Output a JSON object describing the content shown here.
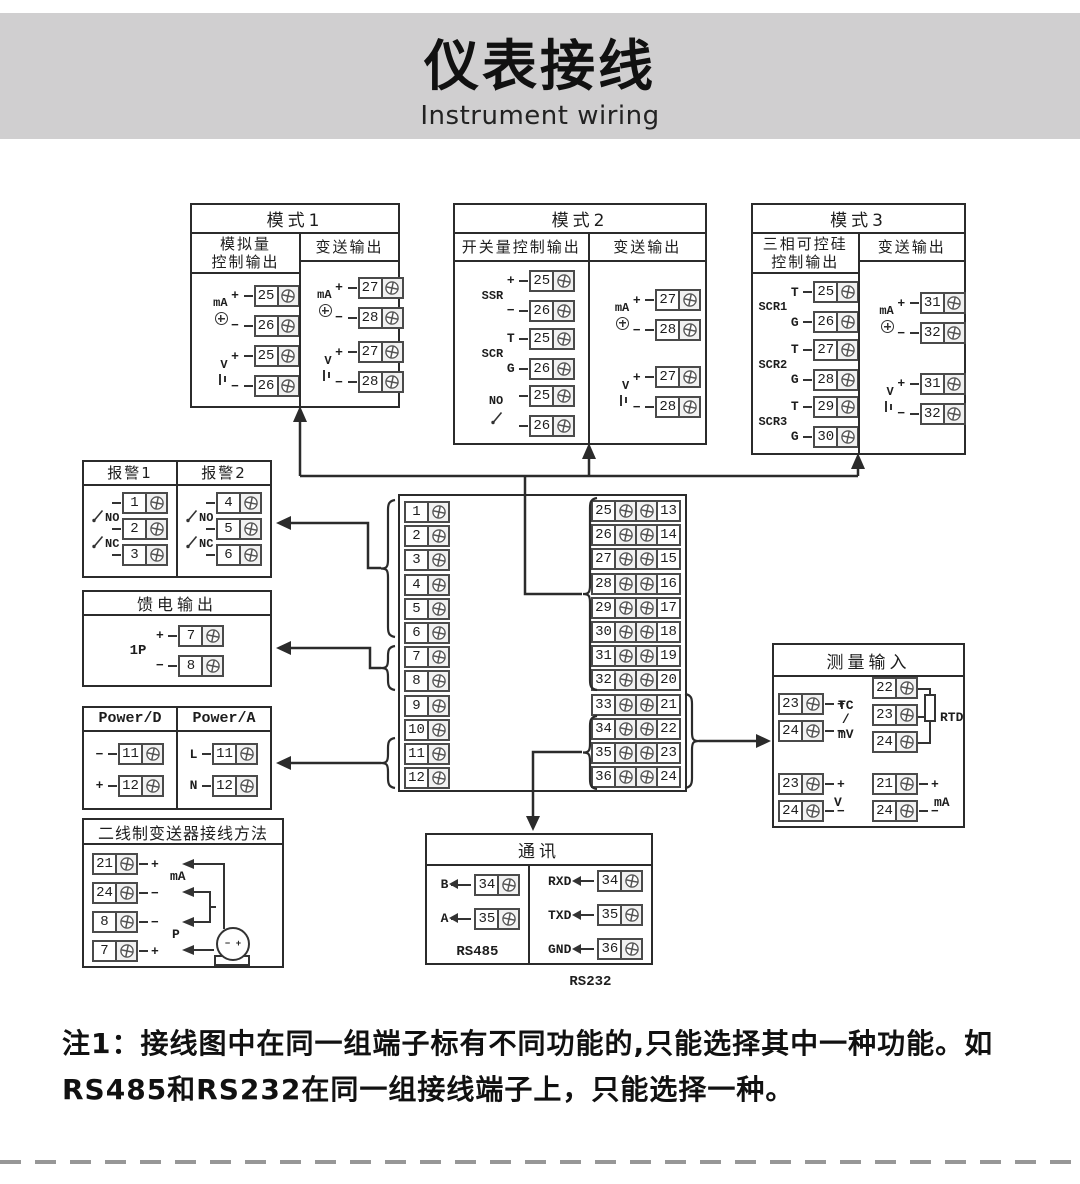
{
  "header": {
    "title": "仪表接线",
    "subtitle": "Instrument wiring"
  },
  "note": {
    "line1": "注1：接线图中在同一组端子标有不同功能的,只能选择其中一种功能。如",
    "line2": "RS485和RS232在同一组接线端子上，只能选择一种。"
  },
  "colors": {
    "band": "#d0cfd0",
    "line": "#2b2b2b",
    "dash": "#979797"
  },
  "boxes": {
    "mode1": {
      "title": "模式1",
      "columns": [
        {
          "header": "模拟量\n控制输出",
          "groups": [
            {
              "label": "mA",
              "symbol": "source",
              "rows": [
                {
                  "pre": "+",
                  "num": "25"
                },
                {
                  "pre": "−",
                  "num": "26"
                }
              ]
            },
            {
              "label": "V",
              "symbol": "battery",
              "rows": [
                {
                  "pre": "+",
                  "num": "25"
                },
                {
                  "pre": "−",
                  "num": "26"
                }
              ]
            }
          ]
        },
        {
          "header": "变送输出",
          "groups": [
            {
              "label": "mA",
              "symbol": "source",
              "rows": [
                {
                  "pre": "+",
                  "num": "27"
                },
                {
                  "pre": "−",
                  "num": "28"
                }
              ]
            },
            {
              "label": "V",
              "symbol": "battery",
              "rows": [
                {
                  "pre": "+",
                  "num": "27"
                },
                {
                  "pre": "−",
                  "num": "28"
                }
              ]
            }
          ]
        }
      ]
    },
    "mode2": {
      "title": "模式2",
      "columns": [
        {
          "header": "开关量控制输出",
          "groups": [
            {
              "label": "SSR",
              "rows": [
                {
                  "pre": "+",
                  "num": "25"
                },
                {
                  "pre": "−",
                  "num": "26"
                }
              ]
            },
            {
              "label": "SCR",
              "rows": [
                {
                  "pre": "T",
                  "num": "25"
                },
                {
                  "pre": "G",
                  "num": "26"
                }
              ]
            },
            {
              "label": "NO",
              "switch": true,
              "rows": [
                {
                  "num": "25"
                },
                {
                  "num": "26"
                }
              ]
            }
          ]
        },
        {
          "header": "变送输出",
          "groups": [
            {
              "label": "mA",
              "symbol": "source",
              "rows": [
                {
                  "pre": "+",
                  "num": "27"
                },
                {
                  "pre": "−",
                  "num": "28"
                }
              ]
            },
            {
              "label": "V",
              "symbol": "battery",
              "rows": [
                {
                  "pre": "+",
                  "num": "27"
                },
                {
                  "pre": "−",
                  "num": "28"
                }
              ]
            }
          ]
        }
      ]
    },
    "mode3": {
      "title": "模式3",
      "columns": [
        {
          "header": "三相可控硅\n控制输出",
          "groups": [
            {
              "label": "SCR1",
              "rows": [
                {
                  "pre": "T",
                  "num": "25"
                },
                {
                  "pre": "G",
                  "num": "26"
                }
              ]
            },
            {
              "label": "SCR2",
              "rows": [
                {
                  "pre": "T",
                  "num": "27"
                },
                {
                  "pre": "G",
                  "num": "28"
                }
              ]
            },
            {
              "label": "SCR3",
              "rows": [
                {
                  "pre": "T",
                  "num": "29"
                },
                {
                  "pre": "G",
                  "num": "30"
                }
              ]
            }
          ]
        },
        {
          "header": "变送输出",
          "groups": [
            {
              "label": "mA",
              "symbol": "source",
              "rows": [
                {
                  "pre": "+",
                  "num": "31"
                },
                {
                  "pre": "−",
                  "num": "32"
                }
              ]
            },
            {
              "label": "V",
              "symbol": "battery",
              "rows": [
                {
                  "pre": "+",
                  "num": "31"
                },
                {
                  "pre": "−",
                  "num": "32"
                }
              ]
            }
          ]
        }
      ]
    },
    "alarm": {
      "columns": [
        {
          "header": "报警1",
          "no": "NO",
          "nc": "NC",
          "nums": [
            "1",
            "2",
            "3"
          ]
        },
        {
          "header": "报警2",
          "no": "NO",
          "nc": "NC",
          "nums": [
            "4",
            "5",
            "6"
          ]
        }
      ]
    },
    "feed": {
      "title": "馈电输出",
      "label": "1P",
      "rows": [
        {
          "pre": "+",
          "num": "7"
        },
        {
          "pre": "−",
          "num": "8"
        }
      ]
    },
    "power": {
      "columns": [
        {
          "header": "Power/D",
          "rows": [
            {
              "pre": "−",
              "num": "11"
            },
            {
              "pre": "+",
              "num": "12"
            }
          ]
        },
        {
          "header": "Power/A",
          "rows": [
            {
              "pre": "L",
              "num": "11"
            },
            {
              "pre": "N",
              "num": "12"
            }
          ]
        }
      ]
    },
    "twowire": {
      "title": "二线制变送器接线方法",
      "rows": [
        {
          "num": "21",
          "post": "+"
        },
        {
          "num": "24",
          "post": "−"
        },
        {
          "num": "8",
          "post": "−"
        },
        {
          "num": "7",
          "post": "+"
        }
      ],
      "between": [
        "mA",
        "P"
      ],
      "transmitter": "− +"
    },
    "center": {
      "left": [
        "1",
        "2",
        "3",
        "4",
        "5",
        "6",
        "7",
        "8",
        "9",
        "10",
        "11",
        "12"
      ],
      "mid": [
        "25",
        "26",
        "27",
        "28",
        "29",
        "30",
        "31",
        "32",
        "33",
        "34",
        "35",
        "36"
      ],
      "right": [
        "13",
        "14",
        "15",
        "16",
        "17",
        "18",
        "19",
        "20",
        "21",
        "22",
        "23",
        "24"
      ]
    },
    "measure": {
      "title": "测量输入",
      "groups": [
        {
          "label": "TC\n/\nmV",
          "rows": [
            {
              "num": "23",
              "post": "+"
            },
            {
              "num": "24",
              "post": "−"
            }
          ]
        },
        {
          "label": "RTD",
          "rows": [
            {
              "num": "22"
            },
            {
              "num": "23"
            },
            {
              "num": "24"
            }
          ]
        },
        {
          "label": "V",
          "rows": [
            {
              "num": "23",
              "post": "+"
            },
            {
              "num": "24",
              "post": "−"
            }
          ]
        },
        {
          "label": "mA",
          "rows": [
            {
              "num": "21",
              "post": "+"
            },
            {
              "num": "24",
              "post": "−"
            }
          ]
        }
      ]
    },
    "comm": {
      "title": "通讯",
      "left": {
        "rows": [
          {
            "label": "B",
            "num": "34"
          },
          {
            "label": "A",
            "num": "35"
          }
        ],
        "caption": "RS485"
      },
      "right": {
        "rows": [
          {
            "label": "RXD",
            "num": "34"
          },
          {
            "label": "TXD",
            "num": "35"
          },
          {
            "label": "GND",
            "num": "36"
          }
        ],
        "caption": "RS232"
      }
    }
  }
}
